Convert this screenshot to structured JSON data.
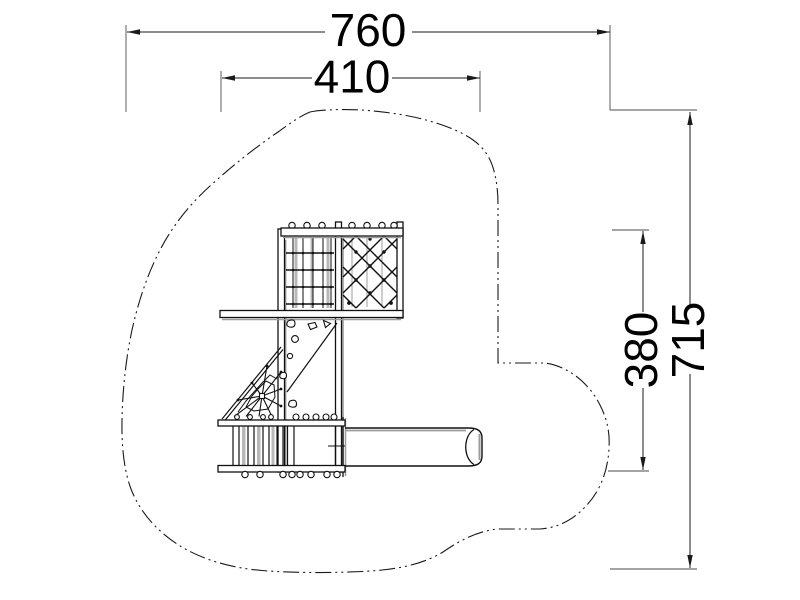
{
  "drawing": {
    "dimensions": {
      "total_width": "760",
      "equipment_width": "410",
      "total_height": "715",
      "equipment_height": "380"
    },
    "colors": {
      "line": "#1a1a1a",
      "shadow": "#9c9c9c",
      "background": "#ffffff"
    }
  }
}
